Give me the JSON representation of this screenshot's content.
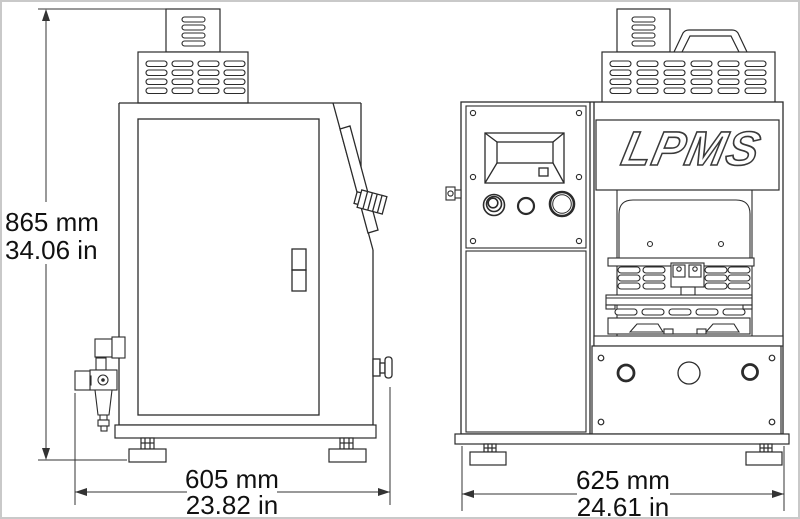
{
  "brand": {
    "logo": "LPMS"
  },
  "dimensions": {
    "height": {
      "metric": "865 mm",
      "imperial": "34.06 in"
    },
    "depth": {
      "metric": "605 mm",
      "imperial": "23.82 in"
    },
    "width": {
      "metric": "625 mm",
      "imperial": "24.61 in"
    }
  },
  "colors": {
    "line": "#2b2b2b",
    "dimension_line": "#333333",
    "background": "#ffffff",
    "frame": "#c9c9c9"
  }
}
